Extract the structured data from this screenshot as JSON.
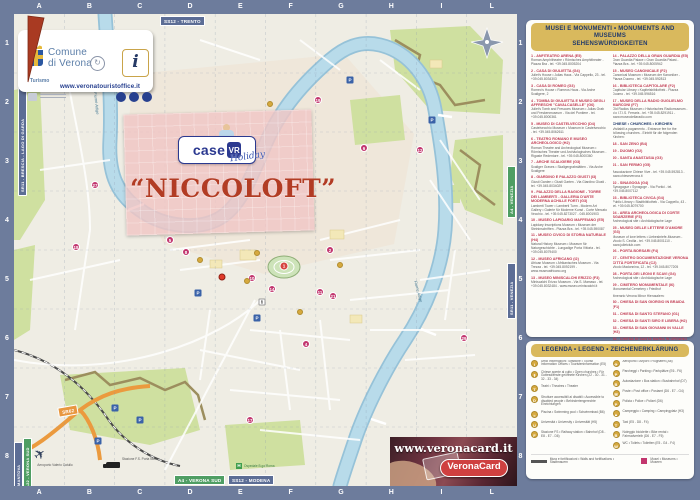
{
  "colors": {
    "frame_blue": "#6d7c9c",
    "map_paper": "#efede4",
    "water": "#b2d5e6",
    "park_green": "#cfe0a0",
    "wall_brown": "#9c8e5e",
    "gold_header": "#d9b95d",
    "navy_text": "#20396b",
    "entry_red": "#c13a52",
    "poi_magenta": "#c2366e",
    "brand_blue": "#2b3990",
    "niccoloft_red": "#b23c24",
    "sign_green": "#4f9e63",
    "sign_orange": "#e8973f"
  },
  "grid": {
    "cols": [
      "A",
      "B",
      "C",
      "D",
      "E",
      "F",
      "G",
      "H",
      "I",
      "L"
    ],
    "rows": [
      "1",
      "2",
      "3",
      "4",
      "5",
      "6",
      "7",
      "8"
    ]
  },
  "logo_card": {
    "name_line1": "Comune",
    "name_line2": "di Verona",
    "turismo": "Turismo",
    "info_i": "i",
    "url": "www.veronatouristoffice.it",
    "socials": [
      "f",
      "t",
      "◎"
    ]
  },
  "overlay": {
    "brand": "case",
    "brand_badge": "VR",
    "brand_script": "Holiday",
    "title": "“NICCOLOFT”"
  },
  "signs": {
    "trento": "SS12 - TRENTO",
    "brescia": "SR11 - BRESCIA - LAGO DI GARDA",
    "mantova": "MANTOVA",
    "a22": "A22 - VERONA SUD",
    "sr62": "SR62",
    "a4_sud": "A4 - VERONA SUD",
    "modena": "SS12 - MODENA",
    "a4_venezia": "A4 - VENEZIA",
    "sr11_venezia": "SR11 - VENEZIA"
  },
  "map_labels": {
    "river1": "Fiume Adige",
    "river2": "Fiume Adige",
    "airport": "Aeroporto Valerio Catullo",
    "station": "Stazione F.S. Porta Nuova",
    "hospital": "Ospedale B.go Roma",
    "hospital_h": "H"
  },
  "veronacard": {
    "url": "www.veronacard.it",
    "logo": "VeronaCard"
  },
  "markers": [
    {
      "n": "1",
      "x": 270,
      "y": 252,
      "type": "red"
    },
    {
      "n": "2",
      "x": 316,
      "y": 236,
      "type": "pin"
    },
    {
      "n": "4",
      "x": 292,
      "y": 330,
      "type": "pin"
    },
    {
      "n": "5",
      "x": 156,
      "y": 226,
      "type": "pin"
    },
    {
      "n": "6",
      "x": 350,
      "y": 134,
      "type": "pin"
    },
    {
      "n": "8",
      "x": 172,
      "y": 238,
      "type": "pin"
    },
    {
      "n": "10",
      "x": 238,
      "y": 264,
      "type": "pin"
    },
    {
      "n": "11",
      "x": 306,
      "y": 278,
      "type": "pin"
    },
    {
      "n": "12",
      "x": 406,
      "y": 136,
      "type": "pin"
    },
    {
      "n": "14",
      "x": 258,
      "y": 275,
      "type": "pin"
    },
    {
      "n": "17",
      "x": 236,
      "y": 406,
      "type": "pin"
    },
    {
      "n": "18",
      "x": 62,
      "y": 233,
      "type": "pin"
    },
    {
      "n": "19",
      "x": 304,
      "y": 86,
      "type": "pin"
    },
    {
      "n": "21",
      "x": 319,
      "y": 282,
      "type": "pin"
    },
    {
      "n": "27",
      "x": 81,
      "y": 171,
      "type": "pin"
    },
    {
      "n": "29",
      "x": 450,
      "y": 324,
      "type": "pin"
    },
    {
      "n": "",
      "x": 243,
      "y": 239,
      "type": "gold"
    },
    {
      "n": "",
      "x": 233,
      "y": 267,
      "type": "gold"
    },
    {
      "n": "",
      "x": 286,
      "y": 298,
      "type": "gold"
    },
    {
      "n": "",
      "x": 326,
      "y": 251,
      "type": "gold"
    },
    {
      "n": "",
      "x": 186,
      "y": 246,
      "type": "gold"
    },
    {
      "n": "",
      "x": 256,
      "y": 90,
      "type": "gold"
    },
    {
      "n": "P",
      "x": 101,
      "y": 394,
      "type": "park"
    },
    {
      "n": "P",
      "x": 126,
      "y": 406,
      "type": "park"
    },
    {
      "n": "P",
      "x": 84,
      "y": 427,
      "type": "park"
    },
    {
      "n": "P",
      "x": 184,
      "y": 279,
      "type": "park"
    },
    {
      "n": "P",
      "x": 243,
      "y": 304,
      "type": "park"
    },
    {
      "n": "P",
      "x": 336,
      "y": 66,
      "type": "park"
    },
    {
      "n": "P",
      "x": 418,
      "y": 106,
      "type": "park"
    },
    {
      "n": "i",
      "x": 248,
      "y": 288,
      "type": "info"
    },
    {
      "n": "",
      "x": 208,
      "y": 263,
      "type": "target"
    }
  ],
  "sidebar": {
    "monuments": {
      "header_line1": "MUSEI E MONUMENTI • MONUMENTS AND MUSEUMS",
      "header_line2": "SEHENSWÜRDIGKEITEN",
      "col1": [
        {
          "k": "e",
          "t": "1 - ANFITEATRO ARENA (E5)",
          "b": "Roman Amphitheatre • Römisches Amphitheater - Piazza Bra - tel. +39.045.8005204"
        },
        {
          "k": "e",
          "t": "2 - CASA DI GIULIETTA (G4)",
          "b": "Juliet's House • Julias Haus - Via Cappello, 23 - tel. +39.045.8034303"
        },
        {
          "k": "e",
          "t": "3 - CASA DI ROMEO (G3)",
          "b": "Romeo's House • Romeos Haus - Via Arche Scaligere, 2"
        },
        {
          "k": "e",
          "t": "4 - TOMBA DI GIULIETTA E MUSEO DEGLI AFFRESCHI \"CAVALCASELLE\" (G6)",
          "b": "Juliet's Tomb and Frescoes Museum • Julias Grab und Freskenmuseum - Via del Pontiere - tel. +39.045.8000361"
        },
        {
          "k": "e",
          "t": "5 - MUSEO DI CASTELVECCHIO (D4)",
          "b": "Castelvecchio Museum • Museum in Castelvecchio - tel. +39.045.8062611"
        },
        {
          "k": "e",
          "t": "6 - TEATRO ROMANO E MUSEO ARCHEOLOGICO (H2)",
          "b": "Roman Theatre and Archeological Museum • Römisches Theater und Archäologisches Museum - Rigaste Redentore - tel. +39.045.8000360"
        },
        {
          "k": "e",
          "t": "7 - ARCHE SCALIGERE (G3)",
          "b": "Scaliger Graves • Skaligergrabstätten - Via Arche Scaligere"
        },
        {
          "k": "e",
          "t": "8 - GIARDINO E PALAZZO GIUSTI (I3)",
          "b": "Giusti Garden • Giusti Garten - Via Giardino Giusti - tel. +39.045.8034029"
        },
        {
          "k": "e",
          "t": "9 - PALAZZO DELLA RAGIONE - TORRE DEI LAMBERTI - GALLERIA D'ARTE MODERNA ACHILLE FORTI (G3)",
          "b": "Lamberti Tower • Lamberti Turm - Modern Art Gallery • Galerie für Moderne Kunst - Corte Mercato Vecchio - tel. +39.045.8273027 - 045.8001903"
        },
        {
          "k": "e",
          "t": "10 - MUSEO LAPIDARIO MAFFEIANO (E5)",
          "b": "Lapidary Inscriptions Museum • Museum der Steininschriften - Piazza Bra - tel. +39.045.590087"
        },
        {
          "k": "e",
          "t": "11 - MUSEO CIVICO DI STORIA NATURALE (H4)",
          "b": "Natural History Museum • Museum für Naturgeschichte - Lungadige Porta Vittoria - tel. +39.045.8079400"
        },
        {
          "k": "e",
          "t": "12 - MUSEO AFRICANO (I2)",
          "b": "African Museum • Afrikanisches Museum - Via Trezza - tel. +39.045.8092199 - www.museoafricano.org"
        },
        {
          "k": "e",
          "t": "13 - MUSEO MINISCALCHI ERIZZO (F3)",
          "b": "Miniscalchi Erizzo Museum - Via S. Mamaso - tel. +39.045.8032484 - www.museo-miniscalchi.it"
        }
      ],
      "col2": [
        {
          "k": "e",
          "t": "14 - PALAZZO DELLA GRAN GUARDIA (E5)",
          "b": "Gran Guardia Palace • Gran Guardia Palast - Piazza Bra - tel. +39.045.8005942"
        },
        {
          "k": "e",
          "t": "15 - MUSEO CANONICALE (F2)",
          "b": "Canonical Museum • Museum der Kanoniker - Piazza Duomo - tel. +39.045.592813"
        },
        {
          "k": "e",
          "t": "16 - BIBLIOTECA CAPITOLARE (F2)",
          "b": "Capitular Library • Kapitelsbibliothek - Piazza Duomo - tel. +39.045.596516"
        },
        {
          "k": "e",
          "t": "17 - MUSEO DELLA RADIO GUGLIELMO MARCONI (F7)",
          "b": "Old Radios Museum • Historisches Radiomuseum - c/o I.T.I.S. Ferraris - tel. +39.045.8291911 - www.museodellaradio.com"
        },
        {
          "k": "h",
          "t": "CHIESE • CHURCHES • KIRCHEN",
          "b": "Visitabili a pagamento - Entrance fee for the following churches - Eintritt für die folgenden Kirchen:"
        },
        {
          "k": "e",
          "t": "18 - SAN ZENO (B4)",
          "b": ""
        },
        {
          "k": "e",
          "t": "19 - DUOMO (G2)",
          "b": ""
        },
        {
          "k": "e",
          "t": "20 - SANTA ANASTASIA (G3)",
          "b": ""
        },
        {
          "k": "e",
          "t": "21 - SAN FERMO (G5)",
          "b": ""
        },
        {
          "k": "n",
          "t": "",
          "b": "Associazione Chiese Vive - tel. +39.045.592813 - www.chieseverona.it"
        },
        {
          "k": "e",
          "t": "22 - SINAGOGA (G4)",
          "b": "Synagogue • Synagoge - Via Portici - tel. +39.045.8007112"
        },
        {
          "k": "e",
          "t": "23 - BIBLIOTECA CIVICA (G4)",
          "b": "Public Library • Stadtbibliothek - Via Cappello, 43 - tel. +39.045.8079700"
        },
        {
          "k": "e",
          "t": "24 - AREA ARCHEOLOGICA DI CORTE SGARZERIE (F3)",
          "b": "Archeological site • Archäologische Lage"
        },
        {
          "k": "e",
          "t": "25 - MUSEO DELLE LETTERE D'AMORE (G3)",
          "b": "Museum of love letters • Liebesbriefe-Museum - Vicolo S. Cecilia - tel. +39.045.8001110 - www.julietclub.com"
        },
        {
          "k": "e",
          "t": "26 - PORTA BORSARI (F4)",
          "b": ""
        },
        {
          "k": "e",
          "t": "27 - CENTRO DOCUMENTAZIONE VERONA CITTÀ FORTIFICATA (C2)",
          "b": "Vicolo Madonnina, 12 - tel. +39.045.8077205"
        },
        {
          "k": "e",
          "t": "28 - PORTA DEI LEONI E SCAVI (G4)",
          "b": "Archeological site • Archäologische Lage"
        },
        {
          "k": "e",
          "t": "29 - CIMITERO MONUMENTALE (I6)",
          "b": "Monumental Cemetery • Friedhof"
        },
        {
          "k": "n",
          "t": "",
          "b": "Itinerario Verona Minor Hierusalem:"
        },
        {
          "k": "e",
          "t": "30 - CHIESA DI SAN GIORGIO IN BRAIDA (F1)",
          "b": ""
        },
        {
          "k": "e",
          "t": "31 - CHIESA DI SANTO STEFANO (G1)",
          "b": ""
        },
        {
          "k": "e",
          "t": "32 - CHIESA DI SANTI SIRO E LIBERA (H2)",
          "b": ""
        },
        {
          "k": "e",
          "t": "33 - CHIESA DI SAN GIOVANNI IN VALLE (H3)",
          "b": ""
        },
        {
          "k": "e",
          "t": "34 - CHIESA DI SANTA MARIA IN ORGANO (H2)",
          "b": ""
        },
        {
          "k": "n",
          "t": "",
          "b": "www.veronaminorhierusalem.it"
        }
      ]
    },
    "legend": {
      "header": "LEGENDA • LEGEND • ZEICHENERKLÄRUNG",
      "col1": [
        {
          "icon": "info",
          "label": "Uffici Informazioni Turistiche • Tourist Information Offices • Touristeninformation (E5)"
        },
        {
          "icon": "church",
          "label": "Chiese aperte al culto • Open churches • Für Gottesdienste geöffnete Kirchen (22 - 30 - 31 - 32 - 33 - 34)"
        },
        {
          "icon": "theatre",
          "label": "Teatri • Theatres • Theater"
        },
        {
          "icon": "disabled",
          "label": "Strutture accessibili ai disabili • Accessible to disabled people • Behindertengerechte Einrichtungen"
        },
        {
          "icon": "pool",
          "label": "Piscina • Swimming pool • Schwimmbad (B6)"
        },
        {
          "icon": "university",
          "label": "Università • University • Universität (H5)"
        },
        {
          "icon": "train",
          "label": "Stazione FS • Railway station • Bahnhof (D8 - E8 - E7 - D6)"
        }
      ],
      "col2": [
        {
          "icon": "plane",
          "label": "Aeroporto • Airport • Flughafen (A8)"
        },
        {
          "icon": "parking",
          "label": "Parcheggi • Parking • Parkplätze (E6 - F6)"
        },
        {
          "icon": "bus",
          "label": "Autostazione • Bus station • Busbahnhof (D7)"
        },
        {
          "icon": "post",
          "label": "Poste • Post office • Postamt (D6 - E7 - G4)"
        },
        {
          "icon": "police",
          "label": "Polizia • Police • Polizei (D6)"
        },
        {
          "icon": "tent",
          "label": "Campeggio • Camping • Campingplatz (H3)"
        },
        {
          "icon": "taxi",
          "label": "Taxi (E5 - D8 - F4)"
        },
        {
          "icon": "bike",
          "label": "Noleggio biciclette • Bike rental • Fahrradverleih (D6 - E7 - F5)"
        },
        {
          "icon": "wc",
          "label": "WC • Toilets • Toiletten (E5 - G4 - F4)"
        }
      ],
      "extras": [
        {
          "swatch": "line",
          "label": "Mura e fortificazioni • Walls and fortifications • Stadtmauern"
        },
        {
          "swatch": "square",
          "label": "Musei • Museums • Museen"
        }
      ]
    }
  }
}
